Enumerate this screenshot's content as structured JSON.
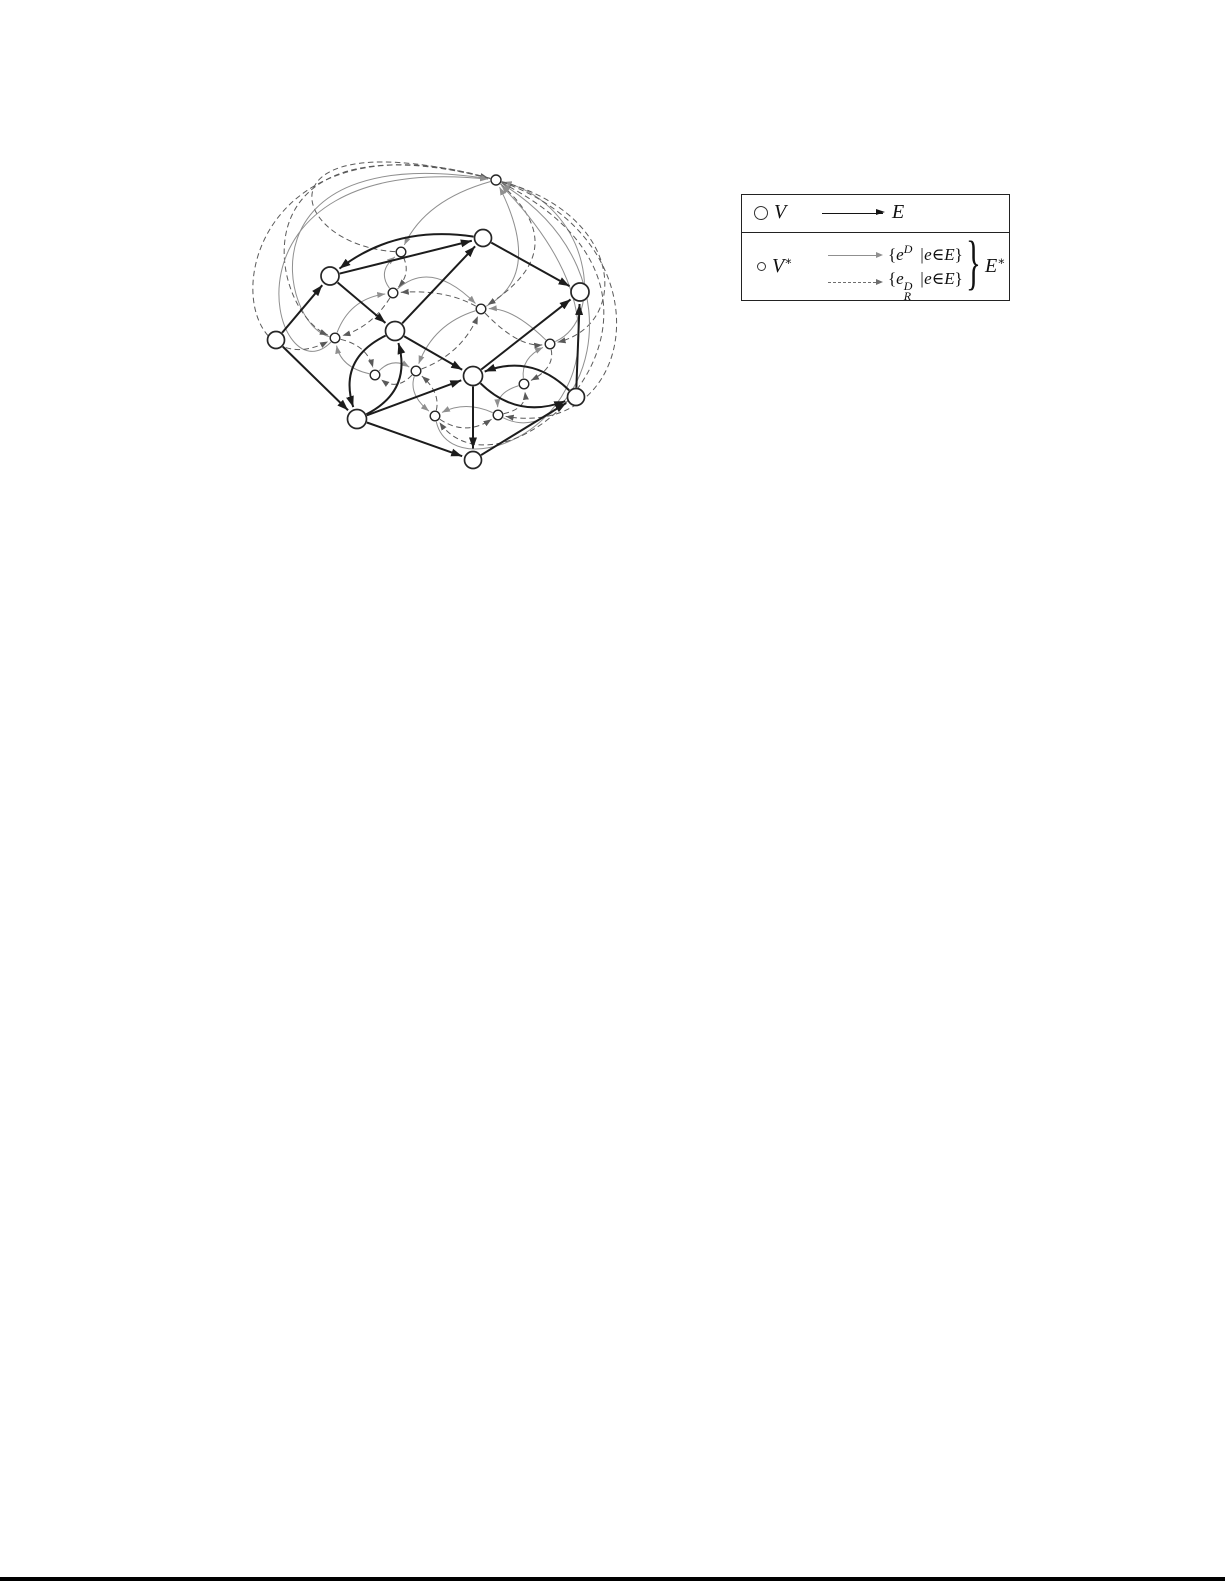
{
  "page": {
    "background": "#ffffff",
    "bottom_rule_color": "#000000"
  },
  "legend": {
    "row1": {
      "node_label": "V",
      "edge_label": "E"
    },
    "row2": {
      "node_base": "V",
      "node_sup": "∗",
      "solid_open": "{",
      "solid_base": "e",
      "solid_sup": "D",
      "solid_cond": "|e∈E",
      "solid_close": "}",
      "dashed_open": "{",
      "dashed_base": "e",
      "dashed_sup": "D",
      "dashed_sub": "R",
      "dashed_cond": "|e∈E",
      "dashed_close": "}",
      "brace": "}",
      "group_base": "E",
      "group_sup": "∗"
    }
  },
  "diagram": {
    "colors": {
      "primal": "#1c1c1c",
      "dual_solid": "#8f8f8f",
      "dual_dashed": "#5a5a5a",
      "node_fill": "#ffffff",
      "node_stroke": "#262626"
    },
    "primal_nodes": [
      {
        "id": "A",
        "x": 483,
        "y": 238,
        "r": 8.5
      },
      {
        "id": "B",
        "x": 330,
        "y": 276,
        "r": 9
      },
      {
        "id": "C",
        "x": 580,
        "y": 292,
        "r": 9
      },
      {
        "id": "D",
        "x": 276,
        "y": 340,
        "r": 8.5
      },
      {
        "id": "E",
        "x": 395,
        "y": 331,
        "r": 9.5
      },
      {
        "id": "F",
        "x": 473,
        "y": 376,
        "r": 9.5
      },
      {
        "id": "G",
        "x": 576,
        "y": 397,
        "r": 8.5
      },
      {
        "id": "H",
        "x": 357,
        "y": 419,
        "r": 9.5
      },
      {
        "id": "I",
        "x": 473,
        "y": 460,
        "r": 8.5
      }
    ],
    "dual_nodes": [
      {
        "id": "n0",
        "x": 496,
        "y": 180,
        "r": 5
      },
      {
        "id": "n1",
        "x": 401,
        "y": 252,
        "r": 4.8
      },
      {
        "id": "n2",
        "x": 393,
        "y": 293,
        "r": 4.8
      },
      {
        "id": "n3",
        "x": 481,
        "y": 309,
        "r": 4.8
      },
      {
        "id": "n4",
        "x": 335,
        "y": 338,
        "r": 4.8
      },
      {
        "id": "n5",
        "x": 375,
        "y": 375,
        "r": 4.8
      },
      {
        "id": "n6",
        "x": 416,
        "y": 371,
        "r": 4.8
      },
      {
        "id": "n7",
        "x": 550,
        "y": 344,
        "r": 4.8
      },
      {
        "id": "n8",
        "x": 524,
        "y": 384,
        "r": 4.8
      },
      {
        "id": "n9",
        "x": 435,
        "y": 416,
        "r": 4.8
      },
      {
        "id": "n10",
        "x": 498,
        "y": 415,
        "r": 4.8
      }
    ],
    "primal_edges": [
      {
        "f": "A",
        "t": "B",
        "via": [
          401,
          241
        ]
      },
      {
        "f": "B",
        "t": "A"
      },
      {
        "f": "A",
        "t": "C"
      },
      {
        "f": "D",
        "t": "B"
      },
      {
        "f": "D",
        "t": "H"
      },
      {
        "f": "B",
        "t": "E"
      },
      {
        "f": "E",
        "t": "A"
      },
      {
        "f": "E",
        "t": "H",
        "via": [
          357,
          367
        ]
      },
      {
        "f": "H",
        "t": "E",
        "via": [
          394,
          383
        ]
      },
      {
        "f": "E",
        "t": "F"
      },
      {
        "f": "H",
        "t": "F"
      },
      {
        "f": "F",
        "t": "C"
      },
      {
        "f": "G",
        "t": "C"
      },
      {
        "f": "G",
        "t": "F",
        "via": [
          528,
          370
        ]
      },
      {
        "f": "F",
        "t": "G",
        "via": [
          521,
          403
        ]
      },
      {
        "f": "F",
        "t": "I"
      },
      {
        "f": "I",
        "t": "G"
      },
      {
        "f": "H",
        "t": "I"
      }
    ],
    "dual_edges": [
      {
        "f": "n0",
        "t": "n1",
        "s": "solid",
        "via": [
          437,
          208
        ]
      },
      {
        "f": "n1",
        "t": "n0",
        "s": "dashed",
        "c1": [
          285,
          245
        ],
        "c2": [
          255,
          118
        ]
      },
      {
        "f": "n2",
        "t": "n1",
        "s": "solid",
        "via": [
          387,
          272
        ]
      },
      {
        "f": "n1",
        "t": "n2",
        "s": "dashed",
        "via": [
          404,
          273
        ]
      },
      {
        "f": "n4",
        "t": "n0",
        "s": "solid",
        "c1": [
          280,
          325
        ],
        "c2": [
          240,
          140
        ]
      },
      {
        "f": "n0",
        "t": "n4",
        "s": "dashed",
        "c1": [
          230,
          112
        ],
        "c2": [
          268,
          310
        ]
      },
      {
        "f": "n4",
        "t": "n0",
        "s": "solid",
        "c1": [
          272,
          402
        ],
        "c2": [
          205,
          150
        ]
      },
      {
        "f": "n0",
        "t": "n4",
        "s": "dashed",
        "c1": [
          208,
          98
        ],
        "c2": [
          210,
          402
        ]
      },
      {
        "f": "n4",
        "t": "n2",
        "s": "solid",
        "via": [
          357,
          307
        ]
      },
      {
        "f": "n2",
        "t": "n4",
        "s": "dashed",
        "via": [
          368,
          321
        ]
      },
      {
        "f": "n2",
        "t": "n3",
        "s": "solid",
        "via": [
          434,
          280
        ]
      },
      {
        "f": "n3",
        "t": "n2",
        "s": "dashed",
        "via": [
          441,
          295
        ]
      },
      {
        "f": "n5",
        "t": "n4",
        "s": "solid",
        "via": [
          348,
          362
        ]
      },
      {
        "f": "n4",
        "t": "n5",
        "s": "dashed",
        "via": [
          361,
          351
        ]
      },
      {
        "f": "n5",
        "t": "n6",
        "s": "solid",
        "via": [
          394,
          365
        ]
      },
      {
        "f": "n6",
        "t": "n5",
        "s": "dashed",
        "via": [
          396,
          382
        ]
      },
      {
        "f": "n3",
        "t": "n6",
        "s": "solid",
        "via": [
          441,
          332
        ]
      },
      {
        "f": "n6",
        "t": "n3",
        "s": "dashed",
        "via": [
          455,
          347
        ]
      },
      {
        "f": "n6",
        "t": "n9",
        "s": "solid",
        "via": [
          417,
          394
        ]
      },
      {
        "f": "n9",
        "t": "n6",
        "s": "dashed",
        "via": [
          433,
          393
        ]
      },
      {
        "f": "n7",
        "t": "n3",
        "s": "solid",
        "via": [
          514,
          317
        ]
      },
      {
        "f": "n3",
        "t": "n7",
        "s": "dashed",
        "via": [
          517,
          337
        ]
      },
      {
        "f": "n8",
        "t": "n7",
        "s": "solid",
        "via": [
          529,
          361
        ]
      },
      {
        "f": "n7",
        "t": "n8",
        "s": "dashed",
        "via": [
          546,
          366
        ]
      },
      {
        "f": "n8",
        "t": "n10",
        "s": "solid",
        "via": [
          504,
          396
        ]
      },
      {
        "f": "n10",
        "t": "n8",
        "s": "dashed",
        "via": [
          519,
          404
        ]
      },
      {
        "f": "n10",
        "t": "n9",
        "s": "solid",
        "via": [
          466,
          408
        ]
      },
      {
        "f": "n9",
        "t": "n10",
        "s": "dashed",
        "via": [
          466,
          426
        ]
      },
      {
        "f": "n3",
        "t": "n0",
        "s": "solid",
        "via": [
          516,
          260
        ]
      },
      {
        "f": "n0",
        "t": "n3",
        "s": "dashed",
        "via": [
          532,
          247
        ]
      },
      {
        "f": "n7",
        "t": "n0",
        "s": "solid",
        "c1": [
          607,
          318
        ],
        "c2": [
          590,
          205
        ]
      },
      {
        "f": "n0",
        "t": "n7",
        "s": "dashed",
        "c1": [
          625,
          215
        ],
        "c2": [
          630,
          325
        ]
      },
      {
        "f": "n10",
        "t": "n0",
        "s": "solid",
        "c1": [
          575,
          455
        ],
        "c2": [
          655,
          280
        ]
      },
      {
        "f": "n0",
        "t": "n10",
        "s": "dashed",
        "c1": [
          668,
          240
        ],
        "c2": [
          640,
          440
        ]
      },
      {
        "f": "n9",
        "t": "n0",
        "s": "solid",
        "c1": [
          455,
          505
        ],
        "c2": [
          700,
          390
        ]
      },
      {
        "f": "n0",
        "t": "n9",
        "s": "dashed",
        "c1": [
          735,
          300
        ],
        "c2": [
          505,
          515
        ]
      }
    ]
  }
}
